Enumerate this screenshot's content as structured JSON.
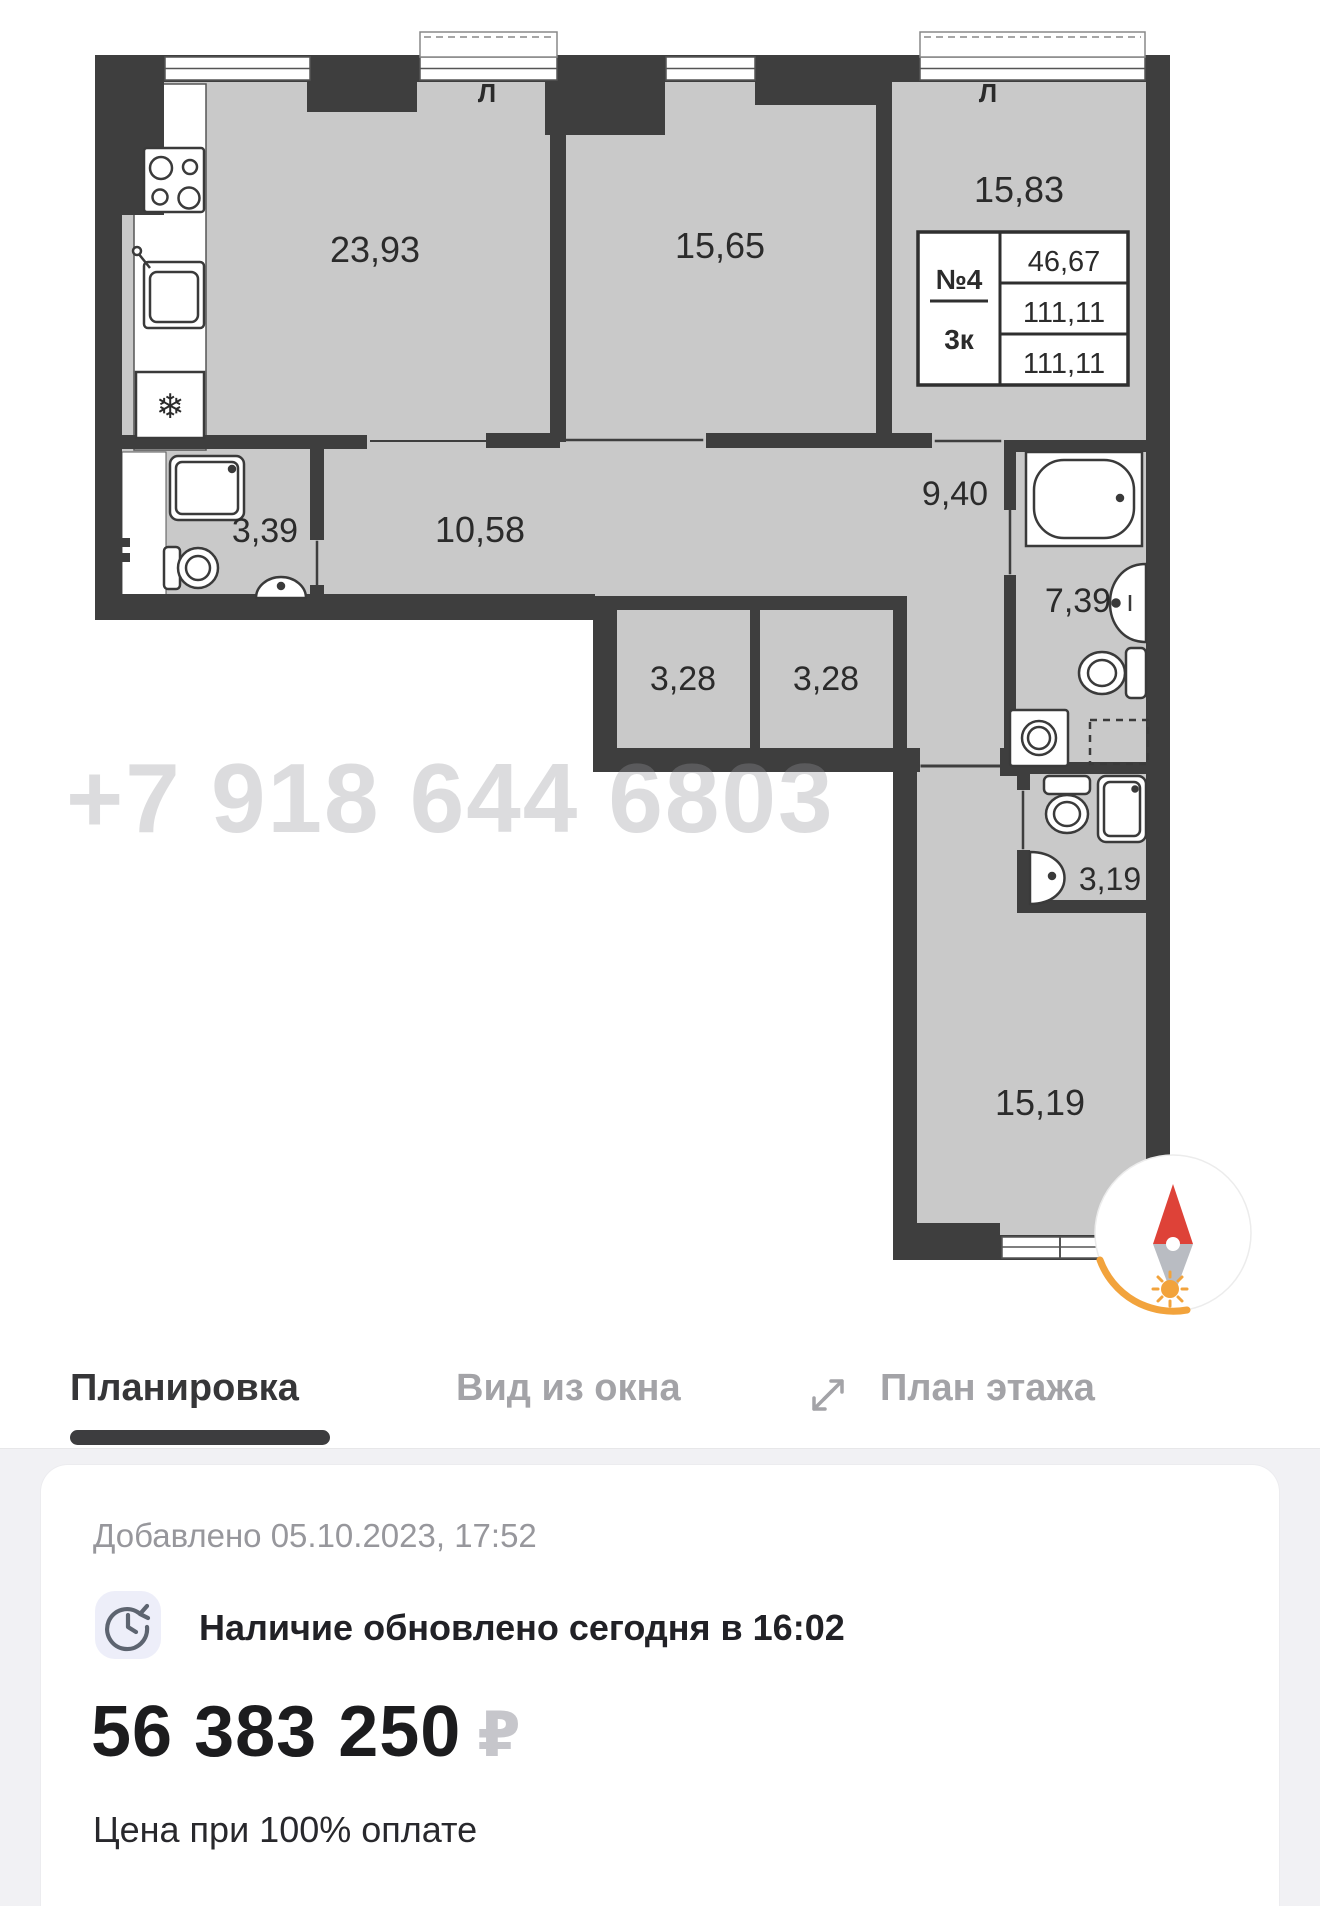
{
  "plan": {
    "rooms": {
      "living_kitchen": "23,93",
      "bedroom_mid": "15,65",
      "bedroom_right": "15,83",
      "hall": "10,58",
      "bath_small": "3,39",
      "corridor": "9,40",
      "bathroom_main": "7,39",
      "closet_left": "3,28",
      "closet_right": "3,28",
      "bath_lower": "3,19",
      "bedroom_lower": "15,19"
    },
    "info_box": {
      "apartment_number": "№4",
      "rooms_type": "3к",
      "area_living": "46,67",
      "area_total": "111,11",
      "area_total_2": "111,11"
    },
    "vent_mark": "Л",
    "freezer_icon": "❄",
    "watermark_phone": "+7 918 644 6803"
  },
  "tabs": [
    {
      "label": "Планировка",
      "active": true
    },
    {
      "label": "Вид из окна",
      "active": false
    },
    {
      "label": "План этажа",
      "active": false
    }
  ],
  "details": {
    "added": "Добавлено 05.10.2023, 17:52",
    "availability": "Наличие обновлено сегодня в 16:02",
    "price": "56 383 250",
    "currency": "₽",
    "price_note": "Цена при 100% оплате"
  },
  "colors": {
    "wall": "#3E3E3E",
    "room_fill": "#C9C9C9",
    "accent_orange": "#F2A33C",
    "needle_red": "#DE4238"
  }
}
